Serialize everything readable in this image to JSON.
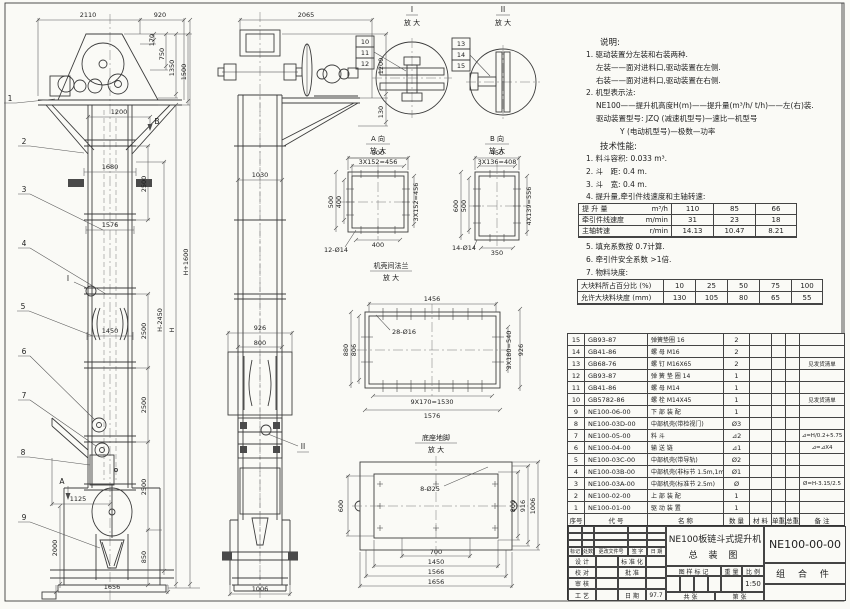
{
  "drawing": {
    "front": {
      "balloons": [
        "1",
        "2",
        "3",
        "4",
        "5",
        "6",
        "7",
        "8",
        "9"
      ],
      "d2110": "2110",
      "d920": "920",
      "d170": "170",
      "d750": "750",
      "d1350": "1350",
      "d1500": "1500",
      "d1200": "1200",
      "d1680": "1680",
      "d1576": "1576",
      "d1450": "1450",
      "d2500": "2500",
      "d850": "850",
      "d1125": "1125",
      "d2000": "2000",
      "d1656": "1656",
      "dH": "H",
      "dHm": "H-2450",
      "dHp": "H+1600",
      "viewA": "A",
      "viewB": "B",
      "detI": "I"
    },
    "side": {
      "d2065": "2065",
      "d1200": "1200",
      "d130": "130",
      "d1030": "1030",
      "d926": "926",
      "d800": "800",
      "d1006": "1006",
      "detII": "II"
    },
    "detailI": {
      "title": "I",
      "zoom": "放 大",
      "refs": [
        "10",
        "11",
        "12"
      ]
    },
    "detailII": {
      "title": "II",
      "zoom": "放 大",
      "refs": [
        "13",
        "14",
        "15"
      ]
    },
    "detailA": {
      "title": "A 向",
      "zoom": "放 大",
      "t500": "500",
      "t456": "3X152=456",
      "l500": "500",
      "l400": "400",
      "r456": "3X152=456",
      "b400": "400",
      "holes": "12-Ø14"
    },
    "detailB": {
      "title": "B 向",
      "zoom": "放 大",
      "t450": "450",
      "t408": "3X136=408",
      "l600": "600",
      "l500": "500",
      "r556": "4X139=556",
      "b350": "350",
      "holes": "14-Ø14"
    },
    "detailF": {
      "title": "机壳间法兰",
      "zoom": "放 大",
      "t1456": "1456",
      "holes": "28-Ø16",
      "l880": "880",
      "l806": "806",
      "r540": "3X180=540",
      "r926": "926",
      "b1530": "9X170=1530",
      "b1576": "1576"
    },
    "detailD": {
      "title": "底座地脚",
      "zoom": "放 大",
      "l600": "600",
      "holes": "8-Ø25",
      "r800": "800",
      "r916": "916",
      "r1006": "1006",
      "b700": "700",
      "b1450": "1450",
      "b1566": "1566",
      "b1656": "1656"
    }
  },
  "notes": {
    "heading": "说明:",
    "l1": "1. 驱动装置分左装和右装两种.",
    "l2": "左装——面对进料口,驱动装置在左侧.",
    "l3": "右装——面对进料口,驱动装置在右侧.",
    "l4": "2. 机型表示法:",
    "l5": "NE100——提升机高度H(m)——提升量(m³/h/ t/h)——左(右)装.",
    "l6": "驱动装置型号: JZQ (减速机型号)—速比—机型号",
    "l7": "Y (电动机型号)—极数—功率"
  },
  "performance": {
    "heading": "技术性能:",
    "l1": "1. 料斗容积: 0.033 m³.",
    "l2": "2. 斗　距: 0.4 m.",
    "l3": "3. 斗　宽: 0.4 m.",
    "l4": "4. 提升量,牵引件线速度和主轴转速:",
    "l5": "5. 填充系数按 0.7计算.",
    "l6": "6. 牵引件安全系数 >1倍.",
    "l7": "7. 物料块度:"
  },
  "lift_table": {
    "rows": [
      {
        "label": "提 升 量",
        "unit": "m³/h",
        "v1": "110",
        "v2": "85",
        "v3": "66"
      },
      {
        "label": "牵引件线速度",
        "unit": "m/min",
        "v1": "31",
        "v2": "23",
        "v3": "18"
      },
      {
        "label": "主轴转速",
        "unit": "r/min",
        "v1": "14.13",
        "v2": "10.47",
        "v3": "8.21"
      }
    ]
  },
  "lump_table": {
    "rows": [
      {
        "label": "大块料所占百分比 (%)",
        "v1": "10",
        "v2": "25",
        "v3": "50",
        "v4": "75",
        "v5": "100"
      },
      {
        "label": "允许大块料块度 (mm)",
        "v1": "130",
        "v2": "105",
        "v3": "80",
        "v4": "65",
        "v5": "55"
      }
    ]
  },
  "bom": {
    "header": {
      "seq": "序号",
      "code": "代  号",
      "name": "名  称",
      "qty": "数 量",
      "mat": "材  料",
      "unit": "单重",
      "total": "总重",
      "remark": "备  注"
    },
    "rows": [
      {
        "seq": "15",
        "code": "GB93-87",
        "name": "弹簧垫圈  16",
        "qty": "2",
        "remark": ""
      },
      {
        "seq": "14",
        "code": "GB41-86",
        "name": "螺 母  M16",
        "qty": "2",
        "remark": ""
      },
      {
        "seq": "13",
        "code": "GB68-76",
        "name": "螺 钉  M16X65",
        "qty": "2",
        "remark": "见发货清单"
      },
      {
        "seq": "12",
        "code": "GB93-87",
        "name": "弹 簧 垫 圈  14",
        "qty": "1",
        "remark": ""
      },
      {
        "seq": "11",
        "code": "GB41-86",
        "name": "螺 母  M14",
        "qty": "1",
        "remark": ""
      },
      {
        "seq": "10",
        "code": "GB5782-86",
        "name": "螺 栓  M14X45",
        "qty": "1",
        "remark": "见发货清单"
      },
      {
        "seq": "9",
        "code": "NE100-06-00",
        "name": "下 部 装 配",
        "qty": "1",
        "remark": ""
      },
      {
        "seq": "8",
        "code": "NE100-03D-00",
        "name": "中部机壳(带检视门)",
        "qty": "Ø3",
        "remark": ""
      },
      {
        "seq": "7",
        "code": "NE100-05-00",
        "name": "料 斗",
        "qty": "⊿2",
        "remark": "⊿=H/0.2+5.75"
      },
      {
        "seq": "6",
        "code": "NE100-04-00",
        "name": "输 送 链",
        "qty": "⊿1",
        "remark": "⊿=⊿X4"
      },
      {
        "seq": "5",
        "code": "NE100-03C-00",
        "name": "中部机壳(带导轨)",
        "qty": "Ø2",
        "remark": ""
      },
      {
        "seq": "4",
        "code": "NE100-03B-00",
        "name": "中部机壳(非标节 1.5m,1m)",
        "qty": "Ø1",
        "remark": ""
      },
      {
        "seq": "3",
        "code": "NE100-03A-00",
        "name": "中部机壳(标准节 2.5m)",
        "qty": "Ø",
        "remark": "Ø=H-3.15/2.5"
      },
      {
        "seq": "2",
        "code": "NE100-02-00",
        "name": "上 部 装 配",
        "qty": "1",
        "remark": ""
      },
      {
        "seq": "1",
        "code": "NE100-01-00",
        "name": "驱 动 装 置",
        "qty": "1",
        "remark": ""
      }
    ]
  },
  "title_block": {
    "rev_cols": [
      "标记",
      "处数",
      "更改文件号",
      "签 字",
      "日 期"
    ],
    "sig_rows": [
      {
        "l": "设 计",
        "m": "标 准 化",
        "r": ""
      },
      {
        "l": "校 对",
        "m": "批 准",
        "r": ""
      },
      {
        "l": "审 核",
        "m": "",
        "r": ""
      },
      {
        "l": "工 艺",
        "m": "日 期",
        "r": "97.7"
      }
    ],
    "title1": "NE100板链斗式提升机",
    "title2": "总  装  图",
    "stamp": "图 样 标 记",
    "weight": "重 量",
    "scale_l": "比 例",
    "scale": "1:50",
    "total_sheets": "共  张",
    "sheet_no": "第  张",
    "code": "NE100-00-00",
    "category": "组 合 件"
  }
}
